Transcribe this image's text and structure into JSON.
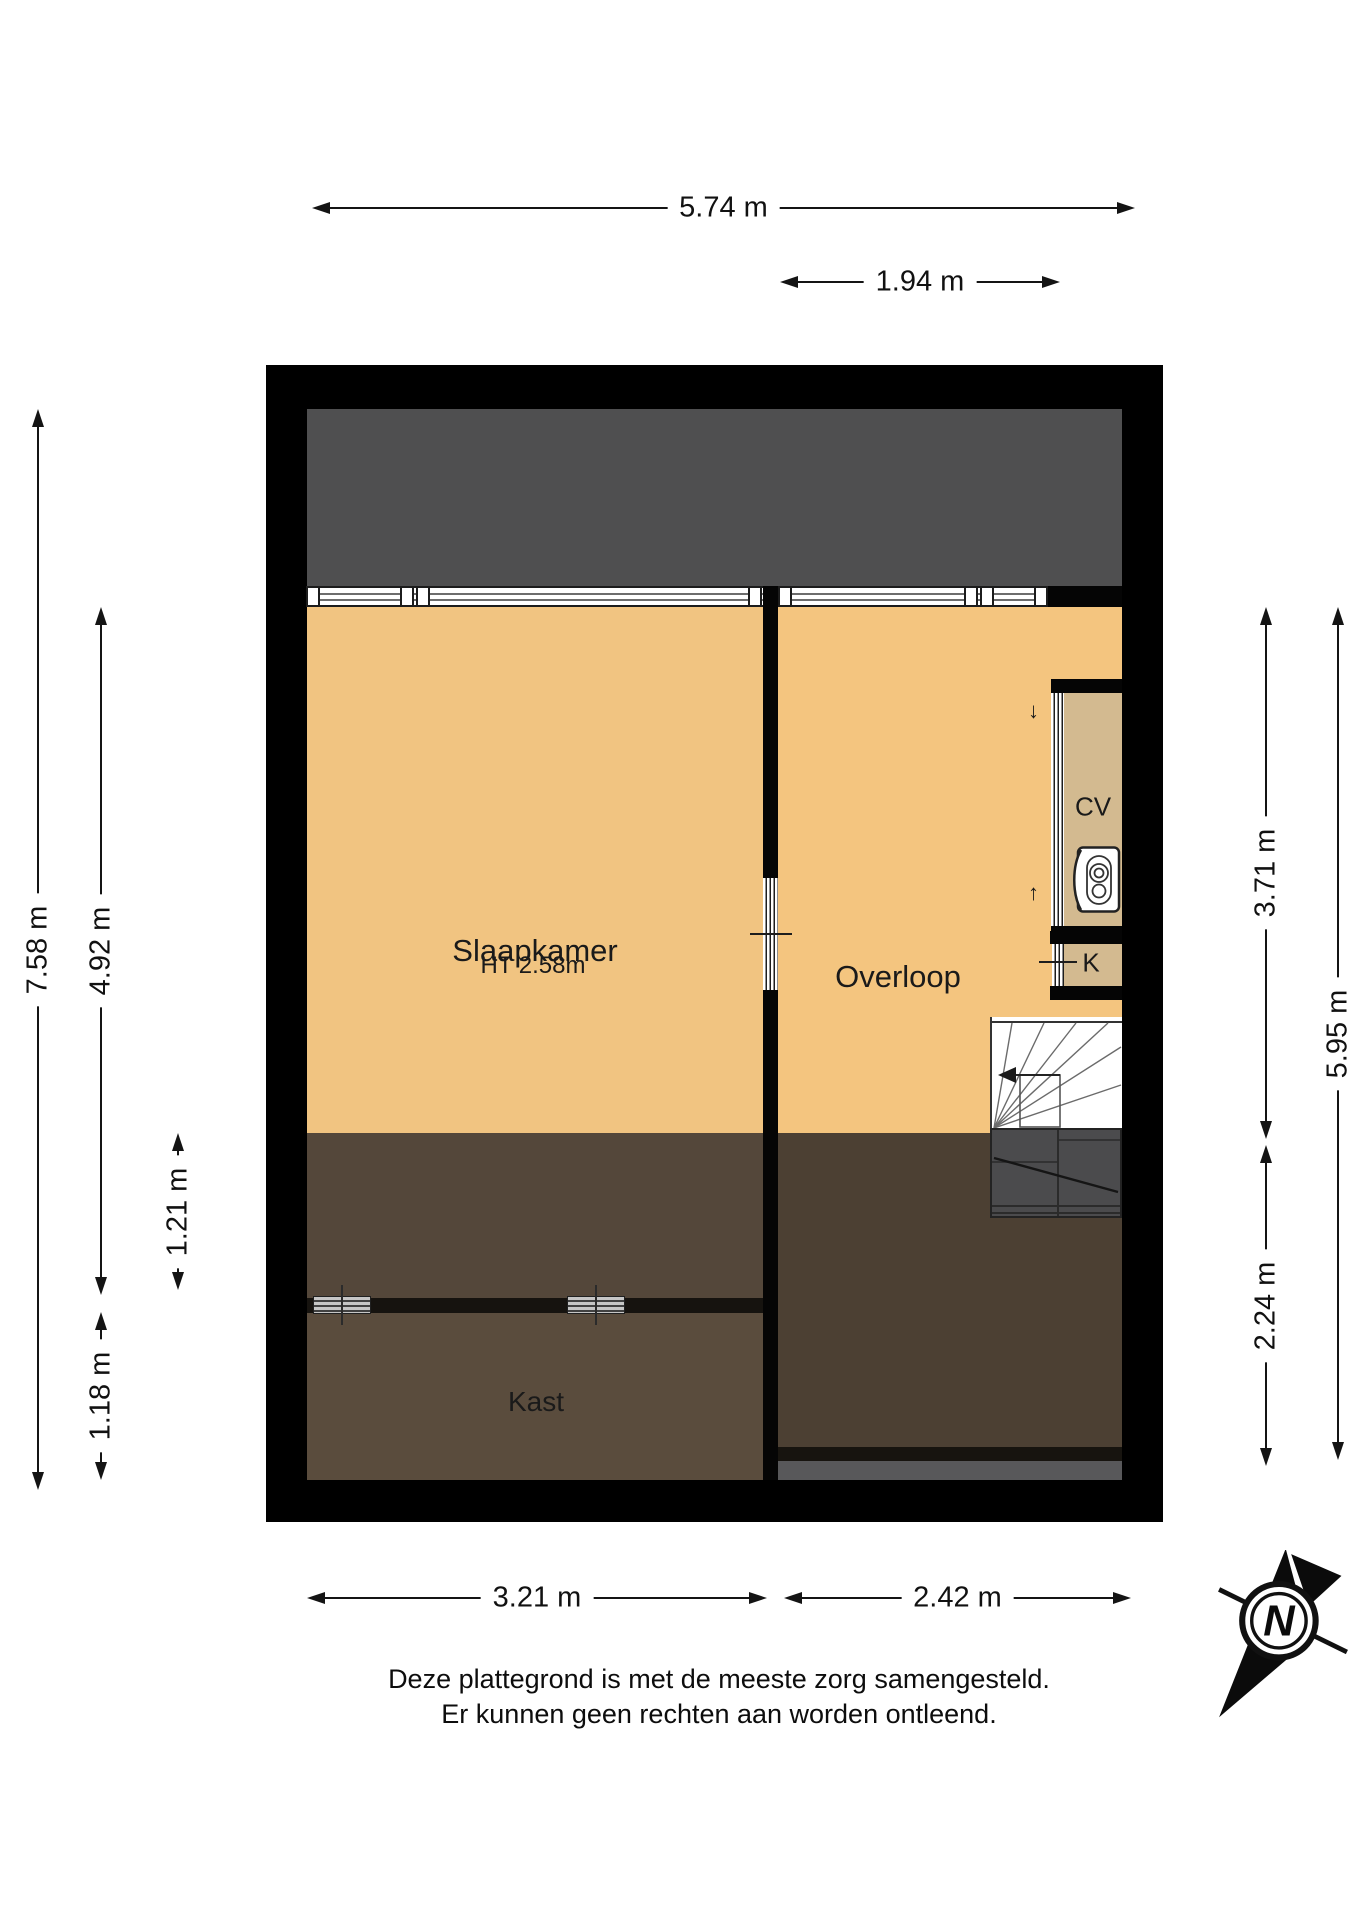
{
  "rooms": {
    "slaapkamer": {
      "label": "Slaapkamer",
      "height_note": "HT 2.58m"
    },
    "overloop": {
      "label": "Overloop"
    },
    "kast": {
      "label": "Kast"
    },
    "cv": {
      "label": "CV"
    },
    "k": {
      "label": "K"
    }
  },
  "dimensions": {
    "top_total": {
      "label": "5.74 m"
    },
    "top_window": {
      "label": "1.94 m"
    },
    "left_total": {
      "label": "7.58 m"
    },
    "left_room": {
      "label": "4.92 m"
    },
    "left_lower": {
      "label": "1.21 m"
    },
    "left_kast": {
      "label": "1.18 m"
    },
    "right_overloop": {
      "label": "3.71 m"
    },
    "right_total": {
      "label": "5.95 m"
    },
    "right_lower": {
      "label": "2.24 m"
    },
    "bottom_slaapkamer": {
      "label": "3.21 m"
    },
    "bottom_overloop": {
      "label": "2.42 m"
    }
  },
  "door_marks": {
    "down_arrow": "↓",
    "up_arrow": "↑"
  },
  "compass": {
    "north_label": "N"
  },
  "footer": {
    "line1": "Deze plattegrond is met de meeste zorg samengesteld.",
    "line2": "Er kunnen geen rechten aan worden ontleend."
  },
  "colors": {
    "wall": "#000000",
    "room_fill": "#f2c480",
    "closet_fill": "#d3ba90",
    "roof_void_gray": "#4f4f50",
    "low_zone_brown": "#54473a",
    "kast_brown": "#5a4c3d",
    "right_zone_brown": "#4c4033",
    "stair_gray": "#4b4b4d",
    "dim_line": "#141414"
  }
}
